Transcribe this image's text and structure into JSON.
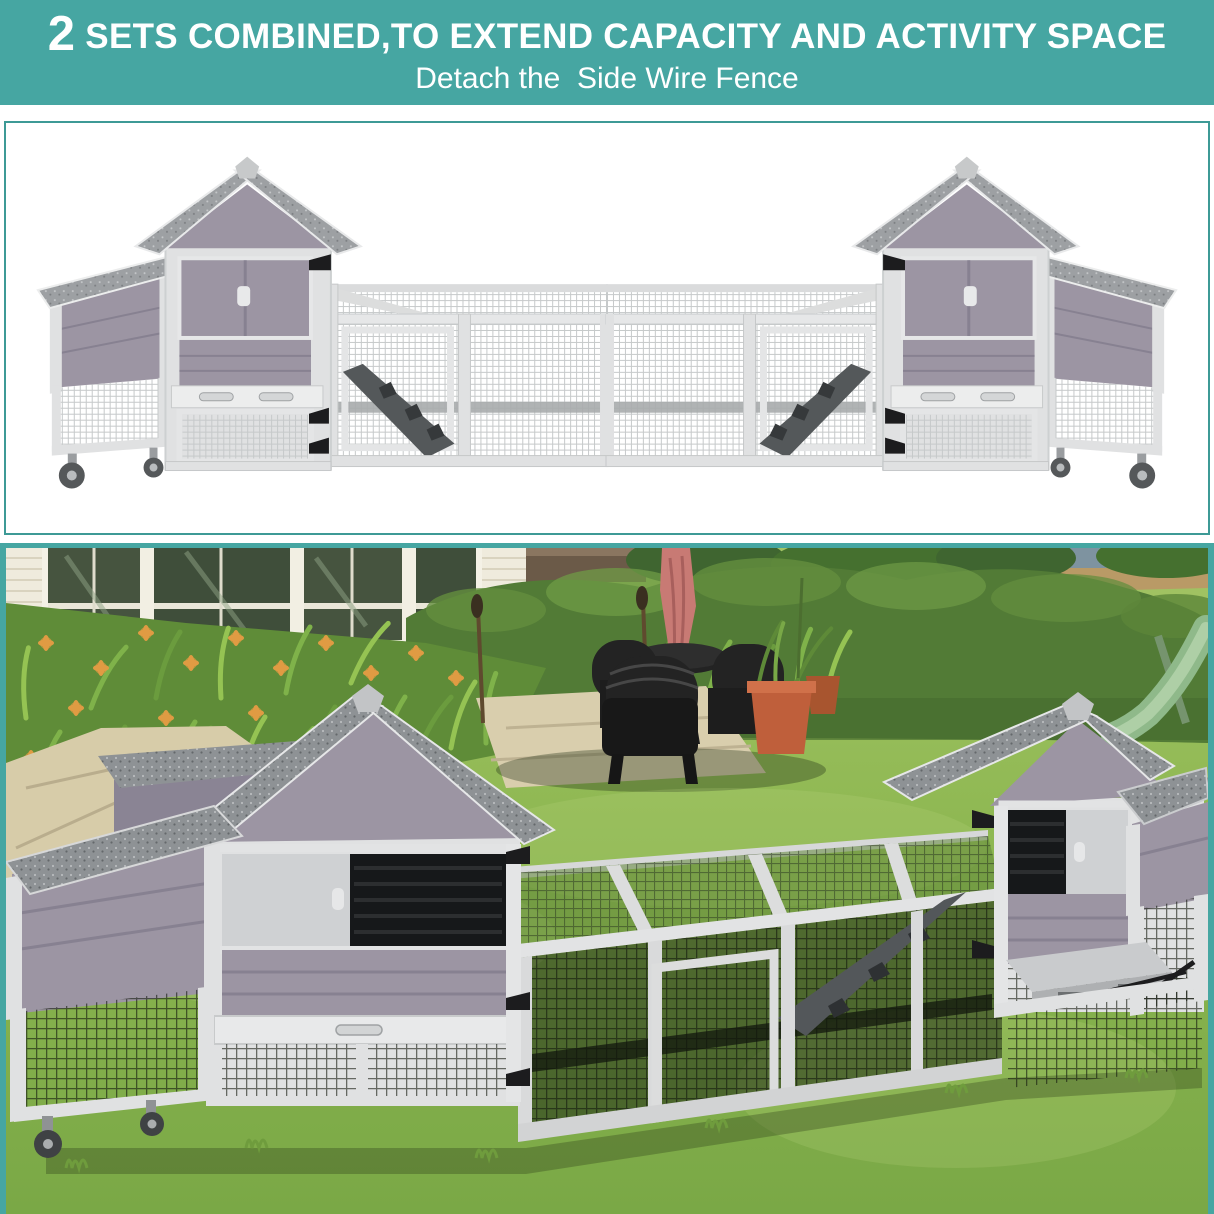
{
  "banner": {
    "number": "2",
    "title": " SETS COMBINED,TO EXTEND CAPACITY AND ACTIVITY SPACE",
    "subtitle": "Detach the  Side Wire Fence"
  },
  "colors": {
    "banner_teal": "#46a6a2",
    "frame_teal": "#3d9a96",
    "panel_white": "#ffffff",
    "text_white": "#ffffff",
    "coop_wall_mauve": "#9c95a3",
    "coop_frame_gray": "#e0e1e2",
    "coop_roof_gray": "#8f9295",
    "coop_mesh_light": "#c6c9ca",
    "hinge_black": "#1c1c1e",
    "window_dark": "#16181a",
    "grass_green": "#8db751",
    "hedge_green": "#527b36",
    "flower_orange": "#df9b43",
    "house_cream": "#efebdd",
    "stone_beige": "#d7cca9",
    "umbrella_pink": "#c87a74",
    "pot_terracotta": "#bf5f3b",
    "furniture_black": "#232323",
    "slide_green": "#8fb98a"
  }
}
